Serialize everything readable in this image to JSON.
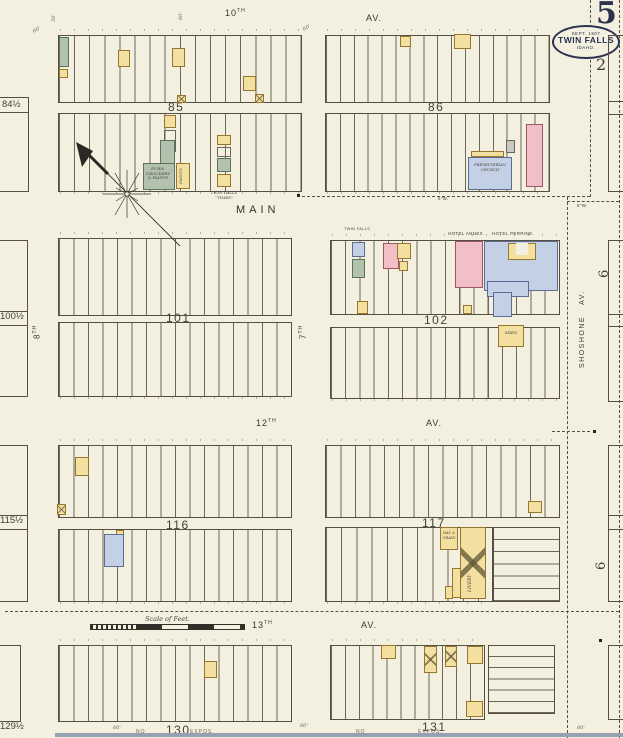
{
  "colors": {
    "paper": "#f3f0df",
    "ink": "#3f3c34",
    "stamp_ink": "#2b3250",
    "frame_yellow": "#f3dfa0",
    "brick_pink": "#f3bfc7",
    "stone_blue": "#c3d0e6",
    "special_green": "#b3c2ae"
  },
  "sheet": {
    "number": "5",
    "adjacent_sheet": "2",
    "adjacent_sheet_right_upper": "6",
    "adjacent_sheet_right_lower": "6",
    "stamp": {
      "date": "SEPT. 1907",
      "city": "TWIN FALLS",
      "state": "IDAHO."
    }
  },
  "streets": {
    "tenth": "10",
    "tenth_sup": "TH",
    "tenth_av": "AV.",
    "main": "MAIN",
    "twelfth": "12",
    "twelfth_sup": "TH",
    "twelfth_av": "AV.",
    "thirteenth": "13",
    "thirteenth_sup": "TH",
    "thirteenth_av": "AV.",
    "seventh": "7",
    "seventh_sup": "TH",
    "eighth": "8",
    "eighth_sup": "TH",
    "shoshone": "SHOSHONE AV."
  },
  "blocks": {
    "b85": "85",
    "b86": "86",
    "b101": "101",
    "b102": "102",
    "b116": "116",
    "b117": "117",
    "b130": "130",
    "b131": "131",
    "edge84": "84½",
    "edge100": "100½",
    "edge115": "115½",
    "edge129": "129½"
  },
  "buildings": {
    "furn_l1": "FURN.",
    "furn_l2": "CROCKERY",
    "furn_l3": "& PAINTS",
    "paints": "PAINTS",
    "times_l1": "TWIN FALLS",
    "times_l2": "“TIMES”",
    "presbyterian_l1": "PRESBYTERIAN",
    "presbyterian_l2": "CHURCH",
    "twin_falls_office": "TWIN FALLS",
    "hotel_annex": "HOTEL ANNEX.",
    "hotel_perrine": "HOTEL PERRINE.",
    "shed": "SHED",
    "hay_l1": "HAY &",
    "hay_l2": "GRAIN",
    "livery": "LIVERY"
  },
  "annotations": {
    "scale_label": "Scale of Feet.",
    "water_main": "6\"W.",
    "dim_60": "60'",
    "dim_50": "50'",
    "dim_80": "80'",
    "clip_no": "NO",
    "clip_expos": "EXPOS."
  }
}
